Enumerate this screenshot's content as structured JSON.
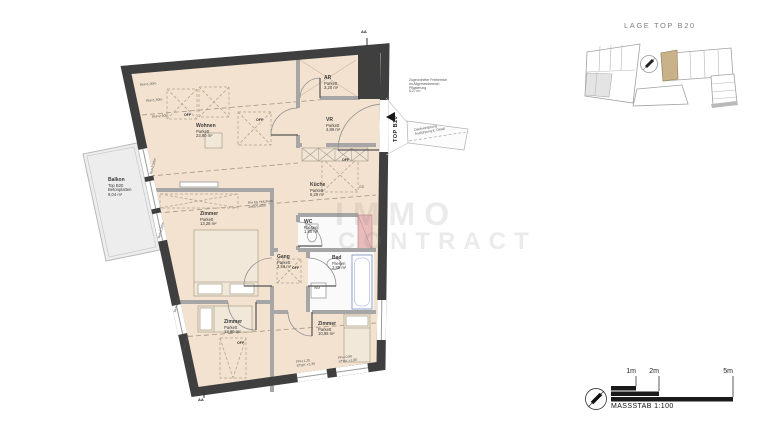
{
  "lage": {
    "title": "LAGE TOP B20"
  },
  "plan": {
    "rooms": [
      {
        "name": "Wohnen",
        "floor": "Parkett",
        "area": "23,80 m²"
      },
      {
        "name": "AR",
        "floor": "Parkett",
        "area": "3,20 m²"
      },
      {
        "name": "VR",
        "floor": "Parkett",
        "area": "4,89 m²"
      },
      {
        "name": "Küche",
        "floor": "Parkett",
        "area": "6,29 m²"
      },
      {
        "name": "WC",
        "floor": "Fliesen",
        "area": "1,80 m²"
      },
      {
        "name": "Bad",
        "floor": "Fliesen",
        "area": "3,85 m²"
      },
      {
        "name": "Gang",
        "floor": "Parkett",
        "area": "3,56 m²"
      },
      {
        "name": "Zimmer",
        "floor": "Parkett",
        "area": "13,28 m²"
      },
      {
        "name": "Zimmer",
        "floor": "Parkett",
        "area": "13,80 m²"
      },
      {
        "name": "Zimmer",
        "floor": "Parkett",
        "area": "10,95 m²"
      }
    ],
    "balcony": {
      "name": "Balkon",
      "unit": "Top B20",
      "floor": "Betonplatten",
      "area": "9,04 m²"
    },
    "entrance_label": "TOP B20",
    "freibereich": {
      "line1": "Zugeordneter Freibereich",
      "line2": "im Allgemeinbereich",
      "line3": "Pflasterung",
      "line4": "6,27 m²"
    },
    "roof_note": {
      "line1": "Dachvorsprung",
      "line2": "Ausführung lt. Detail"
    },
    "rh_note": {
      "line1": "RH bis Holztram",
      "line2": "zirka 5,00m"
    },
    "sill_notes": [
      {
        "line1": "FFH 1,25",
        "line2": "STUK +2,35"
      },
      {
        "line1": "FFH 0,90",
        "line2": "STUK +1,80"
      }
    ],
    "ceiling_height_labels": [
      "RH=1,00m",
      "RH=1,50m",
      "RH=2,50m",
      "RH=2,50m",
      "RH=2,50m",
      "RH=1,00m",
      "FFH=1,00m"
    ],
    "off_labels": [
      "OFF",
      "OFF",
      "OFF",
      "OFF",
      "OFF"
    ],
    "appliance_labels": {
      "dishwasher": "GS",
      "washing_machine": "WM"
    },
    "section_marker": "AA"
  },
  "watermark": {
    "line1": "IMMO",
    "line2": "CONTRACT"
  },
  "scalebar": {
    "tick_labels": [
      "1m",
      "2m",
      "5m"
    ],
    "caption": "MASSSTAB 1:100"
  },
  "colors": {
    "wall": "#3f3f3f",
    "floor": "#f3e2cf",
    "balcony_floor": "#ededed",
    "wet_room": "#fafafa",
    "shaft": "#e9bcbc",
    "highlight_unit": "#c9b289"
  }
}
